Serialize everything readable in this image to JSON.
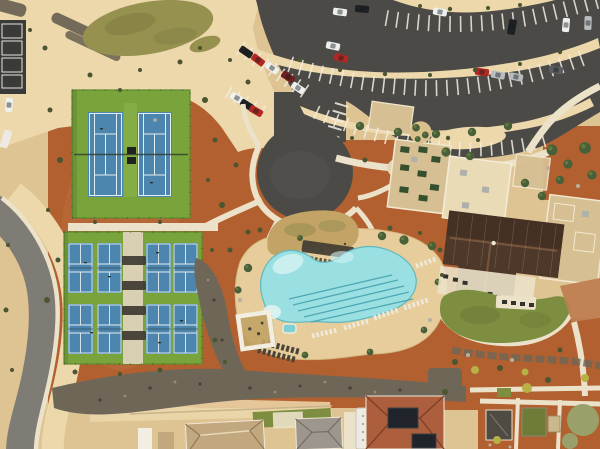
{
  "meta": {
    "domain": "Natural-Image",
    "scene_type": "aerial-drone-photo",
    "description": "Aerial drone view of a desert community recreation center: two tennis courts and eight pickleball courts on green pads, a freeform swimming pool with lap lanes and lounge chairs, a clubhouse with a dark brown gabled roof and flat tan roofs, curved parking lots with cars, a winding access road, gravel washes, red desert landscaping, a community garden and residential roofs along the bottom edge."
  },
  "colors": {
    "sand": "#dfc493",
    "sand_light": "#ecd8ab",
    "dirt_red": "#b2602f",
    "dirt_red_light": "#c97a47",
    "asphalt": "#4b4a46",
    "road_gray": "#7f7c75",
    "concrete": "#ebe2c9",
    "walkway": "#d9cfb3",
    "court_green": "#79a43c",
    "court_green_edge": "#5d8a2c",
    "court_blue": "#4c86ae",
    "court_line": "#e3ecef",
    "canopy_dark": "#403b32",
    "pool_water": "#9adfe2",
    "pool_shallow": "#d0f1f1",
    "pool_lane": "#47a3ae",
    "deck": "#e7cd9c",
    "gravel": "#5f574a",
    "wash": "#6e6758",
    "grass_olive": "#96914f",
    "mound_tan": "#c3a466",
    "lawn": "#7e8e41",
    "roof_brown": "#4e382a",
    "roof_ridge": "#7c5a3e",
    "roof_tan": "#d6bf92",
    "roof_cream": "#e8dbb6",
    "unit_green": "#35502e",
    "tile_red": "#ad5f3d",
    "roof_gray": "#9d968c",
    "house_tan": "#c2a87e",
    "white": "#f2eee2",
    "terracotta": "#bf7f52",
    "tree": "#47603a",
    "tree_light": "#6f7f3c",
    "tree_bright": "#b7b146",
    "shrub": "#4c5531",
    "boulder": "#b9b0a0",
    "sage": "#9aa06a",
    "panel_dark": "#20242a",
    "shed_dark": "#4f4a42",
    "rv_white": "#eceae2",
    "car_white": "#eef0ee",
    "car_black": "#1e2022",
    "car_red": "#b32822",
    "car_silver": "#b9bcbe",
    "car_darkred": "#6e1f1e",
    "car_gray": "#5a5e60"
  },
  "features": {
    "tennis_complex": {
      "label": "tennis courts",
      "court_count": 2
    },
    "pickleball_complex": {
      "label": "pickleball courts",
      "court_count": 8
    },
    "pool": {
      "label": "freeform swimming pool",
      "lap_lanes": 5,
      "amenities": [
        "lounge chairs",
        "shade structure",
        "pergola",
        "spa"
      ]
    },
    "parking": {
      "label": "curved parking lot",
      "car_count": 20
    },
    "clubhouse": {
      "label": "clubhouse with brown gabled roof and flat tan roofs"
    },
    "road": {
      "label": "curved access road with sidewalk"
    },
    "cul_de_sac": {
      "label": "asphalt cul-de-sac turnaround"
    },
    "gravel_wash": {
      "label": "dark gravel drainage washes"
    },
    "grass_mound": {
      "label": "dry grass mounds"
    },
    "lawn": {
      "label": "kidney-shaped event lawn"
    },
    "garden": {
      "label": "community garden beds"
    },
    "homes": {
      "label": "residential roofs with solar panels and RV"
    }
  }
}
